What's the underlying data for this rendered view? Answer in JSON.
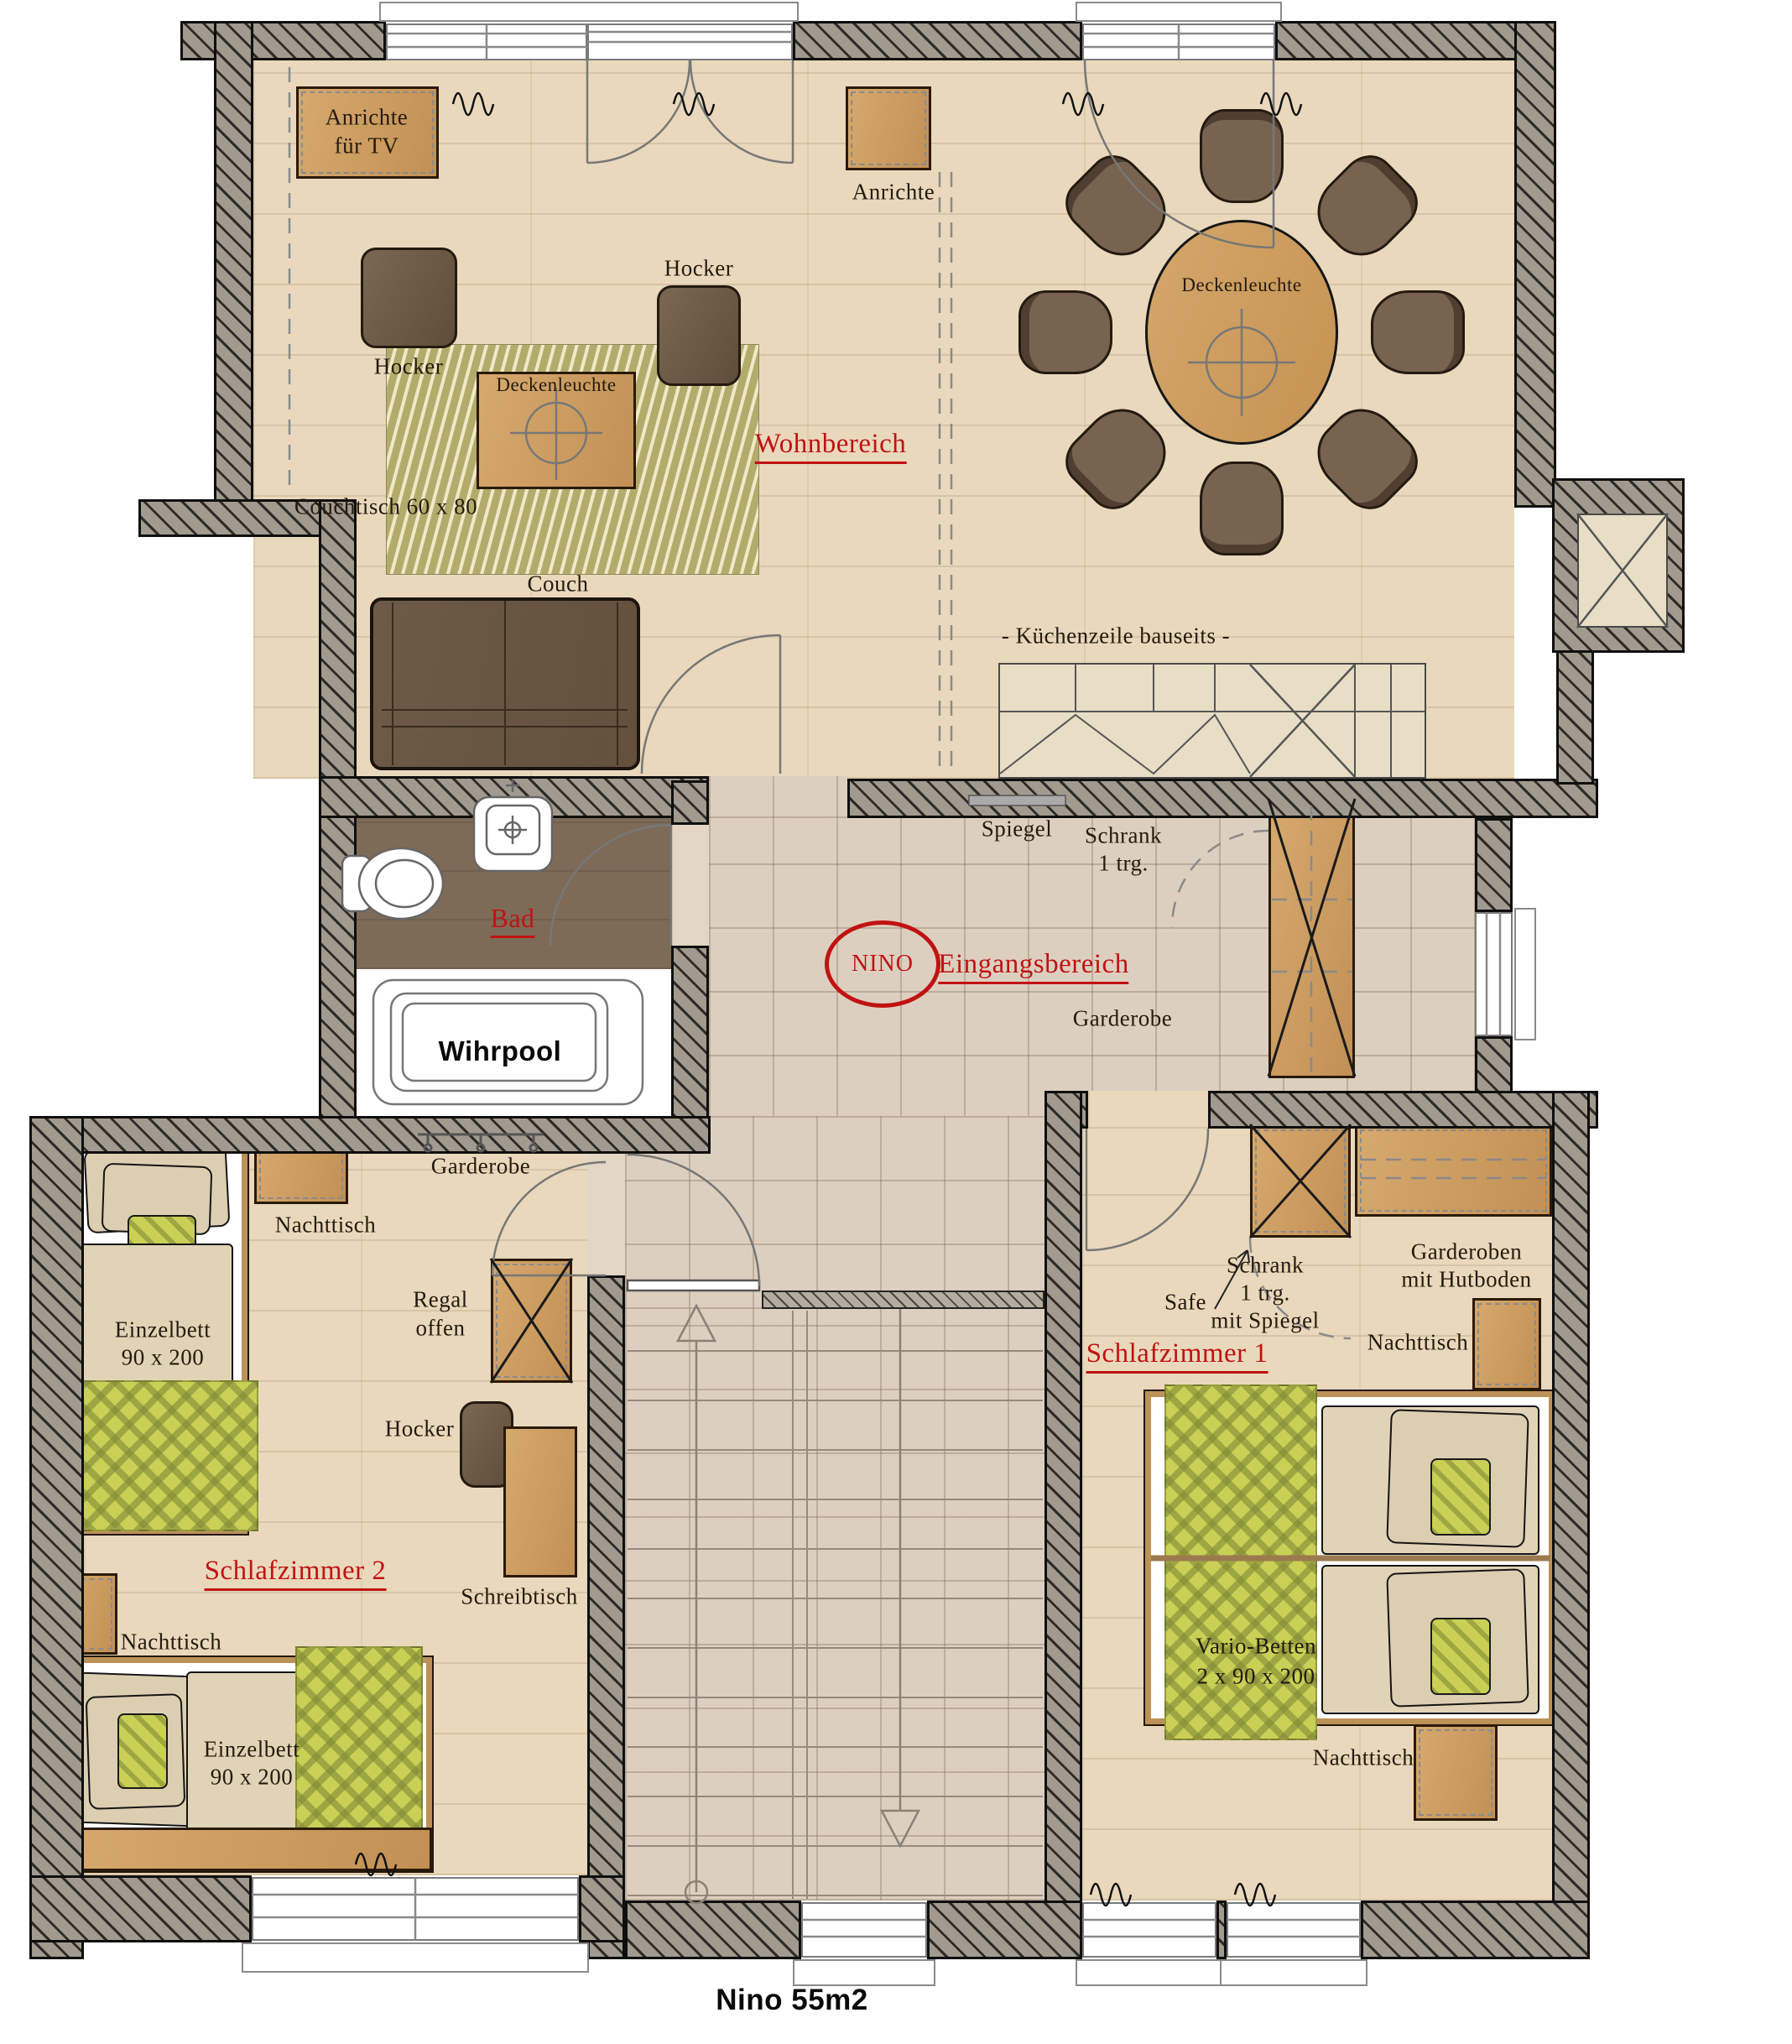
{
  "title": "Nino 55m2",
  "rooms": {
    "wohnbereich": "Wohnbereich",
    "bad": "Bad",
    "eingangsbereich": "Eingangsbereich",
    "schlafzimmer1": "Schlafzimmer 1",
    "schlafzimmer2": "Schlafzimmer 2",
    "nino": "NINO"
  },
  "furniture": {
    "anrichte_tv": [
      "Anrichte",
      "für TV"
    ],
    "hocker": "Hocker",
    "deckenleuchte": "Deckenleuchte",
    "couchtisch": "Couchtisch 60 x 80",
    "couch": "Couch",
    "anrichte": "Anrichte",
    "kuechenzeile": "- Küchenzeile bauseits -",
    "spiegel": "Spiegel",
    "schrank_1trg": [
      "Schrank",
      "1 trg."
    ],
    "garderobe": "Garderobe",
    "wihrpool": "Wihrpool",
    "nachttisch": "Nachttisch",
    "einzelbett": [
      "Einzelbett",
      "90 x 200"
    ],
    "regal_offen": [
      "Regal",
      "offen"
    ],
    "schreibtisch": "Schreibtisch",
    "safe": "Safe",
    "schrank_spiegel": [
      "Schrank",
      "1 trg.",
      "mit Spiegel"
    ],
    "garderoben_hutboden": [
      "Garderoben",
      "mit Hutboden"
    ],
    "vario_betten": [
      "Vario-Betten",
      "2 x 90 x 200"
    ]
  },
  "colors": {
    "label_red": "#c11212",
    "wood_floor": "#e9d8bc",
    "wood_furniture": "#cfa265",
    "textile_green": "#c9d055",
    "tile_floor": "#ddcfbf",
    "bath_floor": "#7d6b58"
  }
}
